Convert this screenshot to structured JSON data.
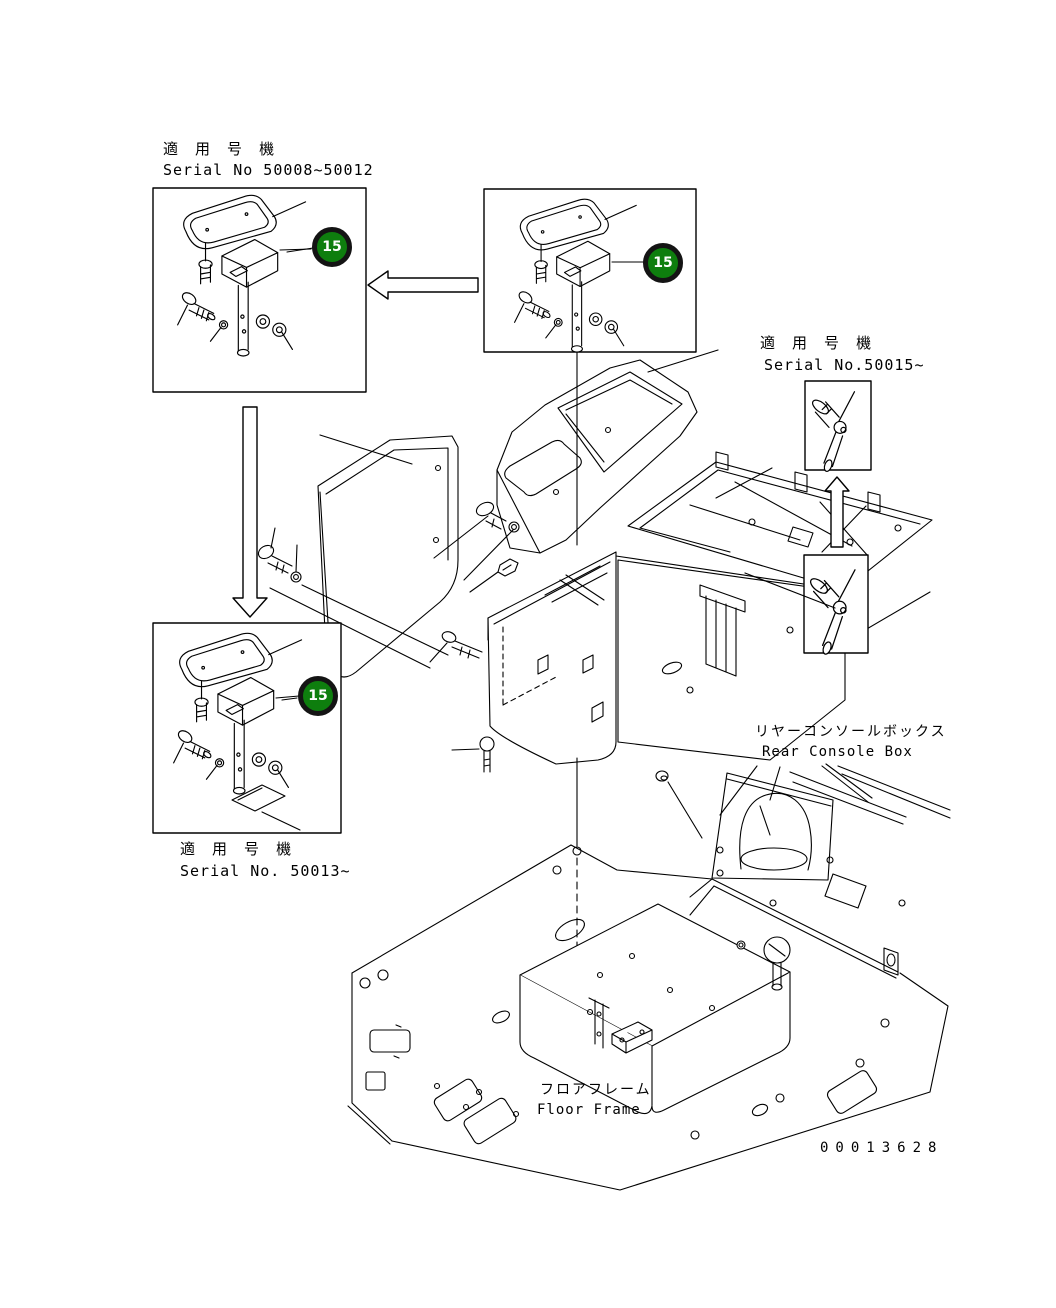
{
  "doc": {
    "type": "parts-diagram",
    "drawing_number": "00013628",
    "background_color": "#ffffff",
    "line_color": "#000000"
  },
  "badges": {
    "fill_color": "#0e7e0e",
    "ring_color": "#141414",
    "text_color": "#ffffff",
    "items": [
      {
        "id": "top-left",
        "number": "15"
      },
      {
        "id": "top-middle",
        "number": "15"
      },
      {
        "id": "bottom-left",
        "number": "15"
      }
    ]
  },
  "labels": {
    "serial_top_left": {
      "jp": "適 用 号 機",
      "en": "Serial No 50008~50012"
    },
    "serial_bottom_left": {
      "jp": "適 用 号 機",
      "en": "Serial No. 50013~"
    },
    "serial_right": {
      "jp": "適 用 号 機",
      "en": "Serial No.50015~"
    },
    "rear_console_box": {
      "jp": "リヤーコンソールボックス",
      "en": "Rear Console Box"
    },
    "floor_frame": {
      "jp": "フロアフレーム",
      "en": "Floor Frame"
    }
  }
}
